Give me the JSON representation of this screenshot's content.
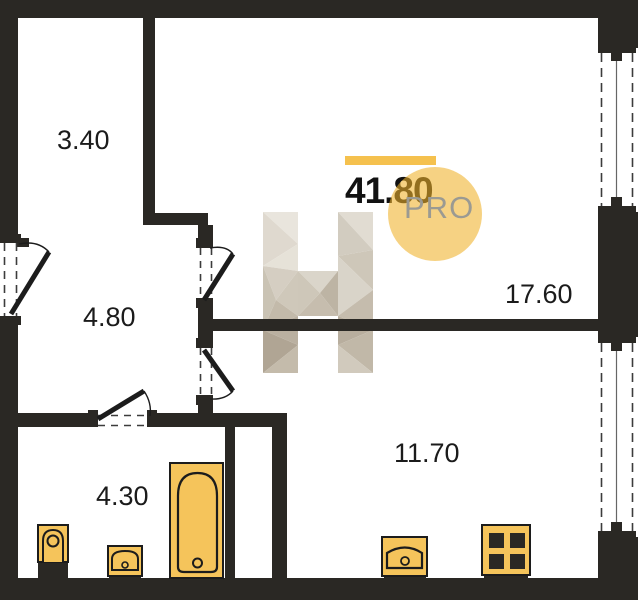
{
  "plan": {
    "title": "apartment-floor-plan",
    "total_area": "41.80",
    "logo_text": "PRO",
    "watermark_letter": "Н",
    "rooms": [
      {
        "name": "wardrobe",
        "area": "3.40"
      },
      {
        "name": "hallway",
        "area": "4.80"
      },
      {
        "name": "bathroom",
        "area": "4.30"
      },
      {
        "name": "living-room",
        "area": "17.60"
      },
      {
        "name": "kitchen",
        "area": "11.70"
      }
    ],
    "fixtures": [
      "toilet-icon",
      "bathroom-sink-icon",
      "bathtub-icon",
      "kitchen-sink-icon",
      "stove-icon"
    ]
  },
  "colors": {
    "wall": "#2A2824",
    "ink": "#1B1B1B",
    "accent": "#F5C14E",
    "circle": "#F0B129",
    "gray": "#9B9A92",
    "fixture": "#F5C45B",
    "outline": "#1C1C1C"
  }
}
